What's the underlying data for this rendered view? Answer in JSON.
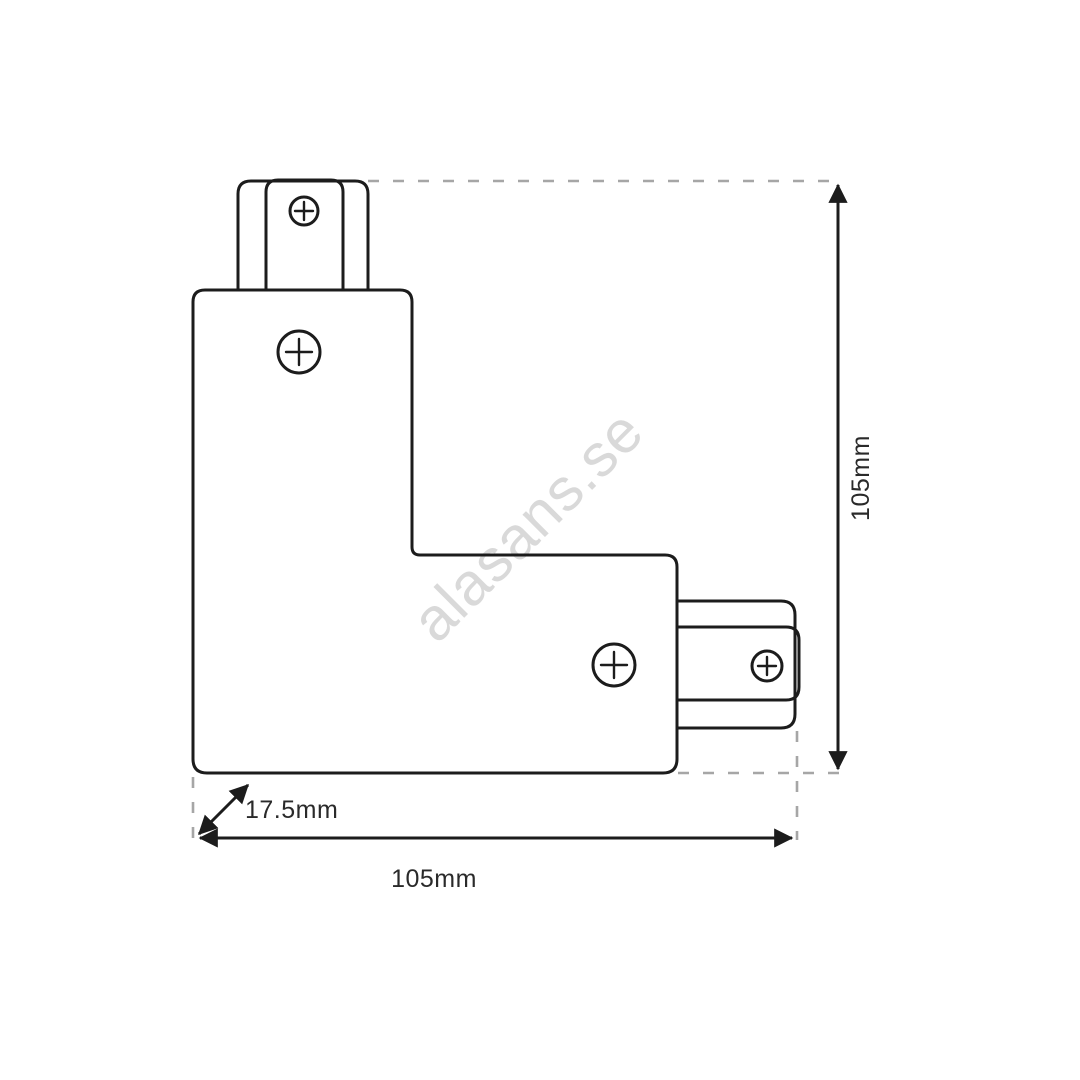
{
  "drawing": {
    "title": "L-shaped track connector dimensional drawing",
    "watermark": {
      "text": "alasans.se",
      "color": "#d9d9d9"
    },
    "colors": {
      "line": "#1c1c1c",
      "dashed_line": "#a6a6a6",
      "label": "#2a2a2a",
      "background": "#ffffff"
    },
    "labels": {
      "height": "105mm",
      "width": "105mm",
      "depth": "17.5mm"
    }
  }
}
